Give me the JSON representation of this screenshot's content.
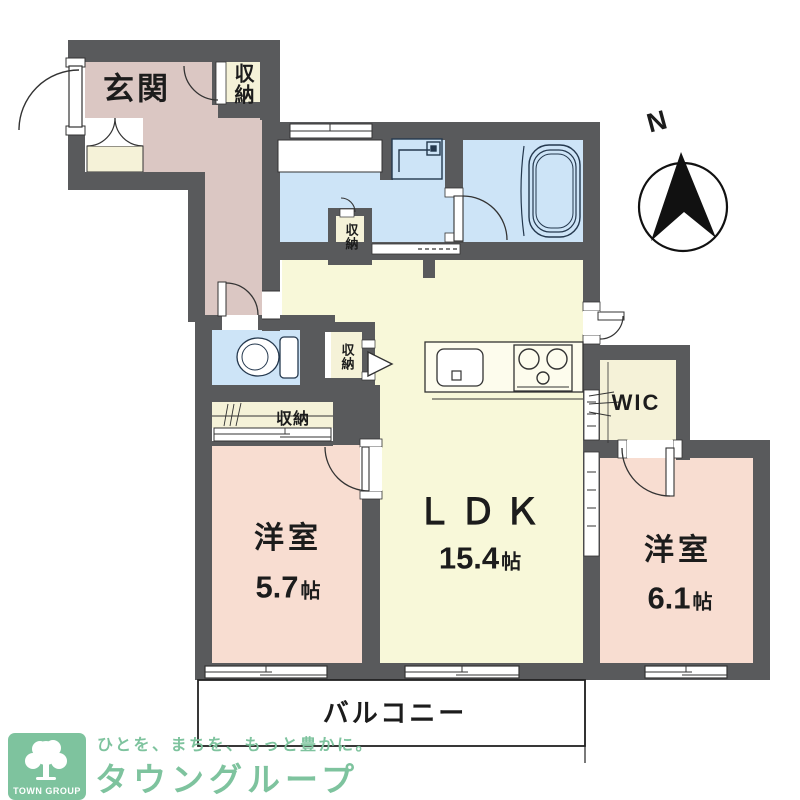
{
  "plan": {
    "rooms": {
      "entrance": "玄関",
      "storage": "収納",
      "wic": "WIC",
      "ldk_name": "ＬＤＫ",
      "ldk_size": "15.4",
      "bedroom_name": "洋室",
      "bedroom_west_size": "5.7",
      "bedroom_east_size": "6.1",
      "size_unit": "帖",
      "balcony": "バルコニー"
    },
    "compass_north": "N"
  },
  "branding": {
    "tagline": "ひとを、まちを、もっと豊かに。",
    "company": "タウングループ",
    "logo_caption": "TOWN GROUP"
  },
  "colors": {
    "wall": "#595a5c",
    "entrance_floor": "#dbc7c3",
    "water_area_floor": "#cde4f7",
    "ldk_floor": "#f8f8d9",
    "bedroom_floor": "#f8ddd1",
    "closet_floor": "#f5f2d8",
    "brand_green": "#7ec39e",
    "fixture_line": "#24384e"
  }
}
